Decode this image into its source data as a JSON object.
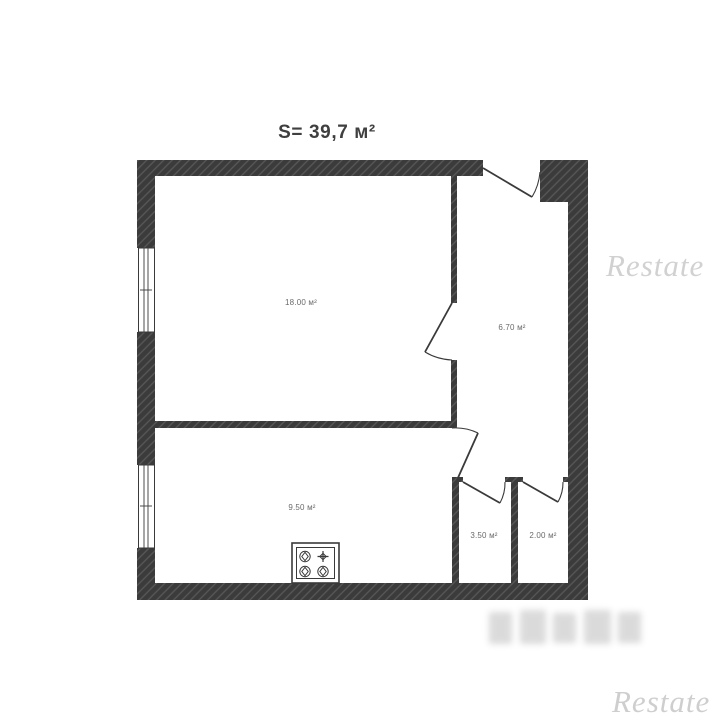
{
  "title": "S= 39,7 м²",
  "plan": {
    "wall_color": "#3b3b3b",
    "hatch_color": "#585858",
    "label_color": "#6a6a6a",
    "rooms": [
      {
        "name": "living-room",
        "area_label": "18.00 м²"
      },
      {
        "name": "hallway",
        "area_label": "6.70 м²"
      },
      {
        "name": "kitchen",
        "area_label": "9.50 м²"
      },
      {
        "name": "bathroom",
        "area_label": "3.50 м²"
      },
      {
        "name": "toilet",
        "area_label": "2.00 м²"
      }
    ],
    "fixtures": [
      {
        "name": "stove",
        "burners": 4
      }
    ],
    "openings": [
      "entrance-door",
      "living-room-door",
      "kitchen-door",
      "bathroom-door",
      "toilet-door"
    ],
    "windows": 2
  },
  "watermarks": {
    "top_right": "Restate",
    "bottom_right": "Restate"
  }
}
